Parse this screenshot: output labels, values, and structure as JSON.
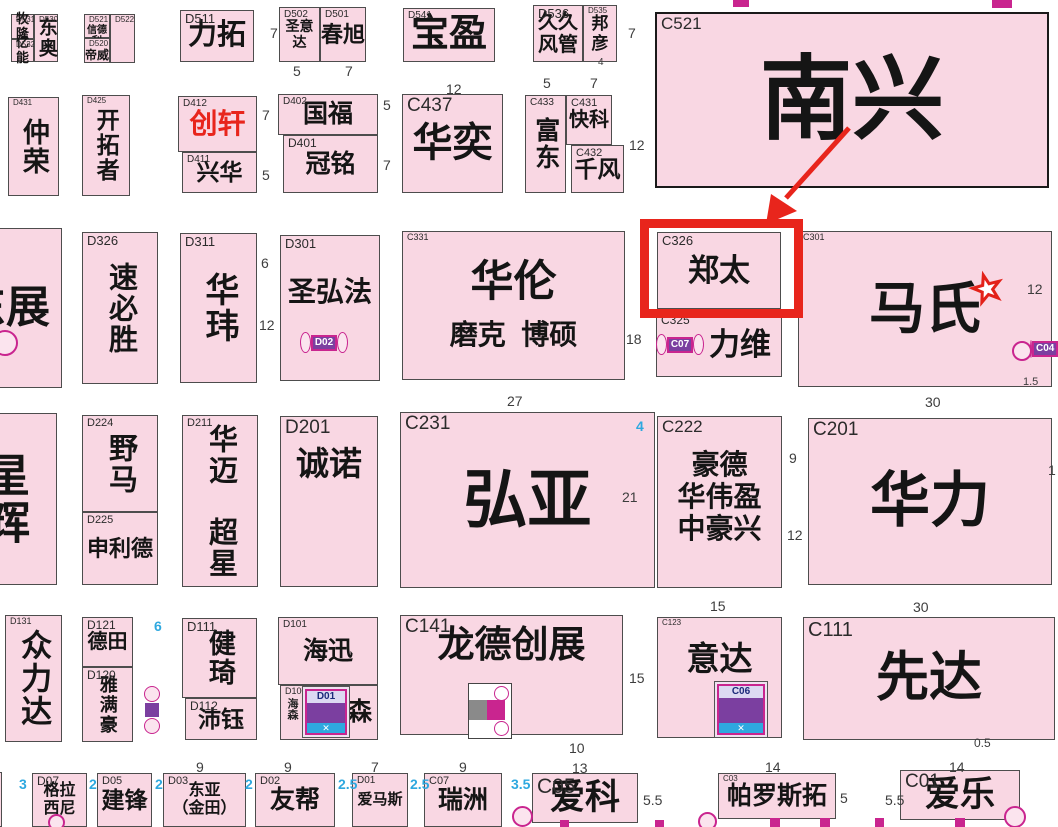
{
  "title": "exhibition-hall-floorplan",
  "colors": {
    "booth_fill": "#F9D7E3",
    "booth_border": "#4d4d4d",
    "big_border": "#1a1a1a",
    "text": "#151515",
    "dim_gray": "#3d3d3d",
    "dim_blue": "#2EA8DF",
    "highlight_red": "#E8251C",
    "special_red": "#E8251C",
    "icon_magenta": "#C9258F",
    "icon_purple": "#7B3FA0",
    "icon_cyan": "#2EA8DF",
    "icon_gray": "#8a8a8a",
    "star_red": "#E32119"
  },
  "highlight": {
    "target_code": "C326",
    "box": {
      "x": 640,
      "y": 219,
      "w": 163,
      "h": 99,
      "bw": 9
    },
    "arrow": {
      "x1": 849,
      "y1": 128,
      "x2": 786,
      "y2": 198,
      "head": "766,224 797,211 771,194"
    }
  },
  "star": {
    "cx": 987,
    "cy": 289,
    "R": 19,
    "r": 7.5,
    "inR": 9.5,
    "inr": 3.8
  },
  "booths": [
    {
      "c": "D531",
      "n": "牧隆",
      "x": 11,
      "y": 14,
      "w": 23,
      "h": 25,
      "s": 13,
      "cs": 8
    },
    {
      "c": "D532",
      "n": "亿能",
      "x": 11,
      "y": 39,
      "w": 23,
      "h": 23,
      "s": 13,
      "cs": 8
    },
    {
      "c": "D530",
      "n": "东奥",
      "x": 34,
      "y": 14,
      "w": 24,
      "h": 48,
      "v": 1,
      "s": 19,
      "cs": 8
    },
    {
      "c": "D521",
      "n": "信德利",
      "x": 84,
      "y": 14,
      "w": 26,
      "h": 24,
      "s": 10,
      "cs": 8,
      "va": "top",
      "tp": 10
    },
    {
      "c": "D520",
      "n": "帝威",
      "x": 84,
      "y": 38,
      "w": 26,
      "h": 25,
      "s": 12,
      "cs": 8,
      "va": "top",
      "tp": 10
    },
    {
      "c": "D522",
      "n": "",
      "x": 110,
      "y": 14,
      "w": 25,
      "h": 49,
      "cs": 8
    },
    {
      "c": "D511",
      "n": "力拓",
      "x": 180,
      "y": 10,
      "w": 74,
      "h": 52,
      "s": 29,
      "cs": 13
    },
    {
      "c": "D502",
      "n": "圣意达",
      "x": 279,
      "y": 7,
      "w": 41,
      "h": 55,
      "s": 14,
      "cs": 10
    },
    {
      "c": "D501",
      "n": "春旭",
      "x": 320,
      "y": 7,
      "w": 46,
      "h": 55,
      "s": 22,
      "cs": 10
    },
    {
      "c": "D541",
      "n": "宝盈",
      "x": 403,
      "y": 8,
      "w": 92,
      "h": 54,
      "s": 38,
      "cs": 10
    },
    {
      "c": "D536",
      "n": "久久\n风管",
      "x": 533,
      "y": 5,
      "w": 50,
      "h": 57,
      "s": 20,
      "cs": 13
    },
    {
      "c": "D535",
      "n": "邦\n彦",
      "x": 583,
      "y": 5,
      "w": 34,
      "h": 57,
      "s": 17,
      "cs": 8
    },
    {
      "c": "C521",
      "n": "南兴",
      "x": 655,
      "y": 12,
      "w": 394,
      "h": 176,
      "s": 92,
      "cs": 17,
      "bw": 2.5
    },
    {
      "c": "D431",
      "n": "仲荣",
      "x": 8,
      "y": 97,
      "w": 51,
      "h": 99,
      "v": 1,
      "s": 27,
      "cs": 8
    },
    {
      "c": "D425",
      "n": "开拓者",
      "x": 82,
      "y": 95,
      "w": 48,
      "h": 101,
      "v": 1,
      "s": 23,
      "cs": 8
    },
    {
      "c": "D412",
      "n": "创轩",
      "x": 178,
      "y": 96,
      "w": 79,
      "h": 56,
      "s": 28,
      "cs": 10,
      "col": "red"
    },
    {
      "c": "D411",
      "n": "兴华",
      "x": 182,
      "y": 152,
      "w": 75,
      "h": 41,
      "s": 23,
      "cs": 10
    },
    {
      "c": "D402",
      "n": "国福",
      "x": 278,
      "y": 94,
      "w": 100,
      "h": 41,
      "s": 25,
      "cs": 10
    },
    {
      "c": "D401",
      "n": "冠铭",
      "x": 283,
      "y": 135,
      "w": 95,
      "h": 58,
      "s": 25,
      "cs": 12
    },
    {
      "c": "C437",
      "n": "华奕",
      "x": 402,
      "y": 94,
      "w": 101,
      "h": 99,
      "s": 40,
      "cs": 19
    },
    {
      "c": "C433",
      "n": "富东",
      "x": 525,
      "y": 95,
      "w": 41,
      "h": 98,
      "v": 1,
      "s": 25,
      "cs": 10
    },
    {
      "c": "C431",
      "n": "快科",
      "x": 566,
      "y": 95,
      "w": 46,
      "h": 50,
      "s": 20,
      "cs": 11
    },
    {
      "c": "C432",
      "n": "千风",
      "x": 571,
      "y": 145,
      "w": 53,
      "h": 48,
      "s": 23,
      "cs": 11
    },
    {
      "c": "",
      "n": "东展",
      "x": -50,
      "y": 228,
      "w": 112,
      "h": 160,
      "s": 44
    },
    {
      "c": "D326",
      "n": "速必胜",
      "x": 82,
      "y": 232,
      "w": 76,
      "h": 152,
      "v": 1,
      "s": 29,
      "cs": 13
    },
    {
      "c": "D311",
      "n": "华玮",
      "x": 180,
      "y": 233,
      "w": 77,
      "h": 150,
      "v": 1,
      "s": 34,
      "cs": 13
    },
    {
      "c": "D301",
      "n": "圣弘法",
      "x": 280,
      "y": 235,
      "w": 100,
      "h": 146,
      "s": 28,
      "cs": 13,
      "va": "top",
      "tp": 40
    },
    {
      "c": "C331",
      "n": "华伦",
      "sub": "磨克  博硕",
      "x": 402,
      "y": 231,
      "w": 223,
      "h": 149,
      "s": 43,
      "ss": 28,
      "cs": 9
    },
    {
      "c": "C326",
      "n": "郑太",
      "x": 657,
      "y": 232,
      "w": 124,
      "h": 77,
      "s": 31,
      "cs": 13
    },
    {
      "c": "C325",
      "n": "力维",
      "x": 656,
      "y": 312,
      "w": 126,
      "h": 65,
      "s": 31,
      "cs": 12,
      "al": "right",
      "rp": 10
    },
    {
      "c": "C301",
      "n": "马氏",
      "x": 798,
      "y": 231,
      "w": 254,
      "h": 156,
      "s": 56,
      "cs": 9
    },
    {
      "c": "",
      "n": "星辉",
      "x": -50,
      "y": 413,
      "w": 107,
      "h": 172,
      "v": 1,
      "s": 45
    },
    {
      "c": "D224",
      "n": "野马",
      "x": 82,
      "y": 415,
      "w": 76,
      "h": 97,
      "v": 1,
      "s": 29,
      "cs": 11
    },
    {
      "c": "D225",
      "n": "申利德",
      "x": 82,
      "y": 512,
      "w": 76,
      "h": 73,
      "s": 22,
      "cs": 11
    },
    {
      "c": "D211",
      "n": "华迈　超星",
      "x": 182,
      "y": 415,
      "w": 76,
      "h": 172,
      "v": 1,
      "s": 29,
      "cs": 11
    },
    {
      "c": "D201",
      "n": "诚诺",
      "x": 280,
      "y": 416,
      "w": 98,
      "h": 171,
      "s": 33,
      "cs": 19,
      "va": "top",
      "tp": 28
    },
    {
      "c": "C231",
      "n": "弘亚",
      "x": 400,
      "y": 412,
      "w": 255,
      "h": 176,
      "s": 64,
      "cs": 19
    },
    {
      "c": "C222",
      "n": "豪德\n华伟盈\n中豪兴",
      "x": 657,
      "y": 416,
      "w": 125,
      "h": 172,
      "s": 28,
      "cs": 17,
      "va": "top",
      "tp": 32
    },
    {
      "c": "C201",
      "n": "华力",
      "x": 808,
      "y": 418,
      "w": 244,
      "h": 167,
      "s": 60,
      "cs": 19
    },
    {
      "c": "D131",
      "n": "众力达",
      "x": 5,
      "y": 615,
      "w": 57,
      "h": 127,
      "v": 1,
      "s": 31,
      "cs": 9
    },
    {
      "c": "D121",
      "n": "德田",
      "x": 82,
      "y": 617,
      "w": 51,
      "h": 50,
      "s": 20,
      "cs": 12
    },
    {
      "c": "D120",
      "n": "雅满豪",
      "x": 82,
      "y": 667,
      "w": 51,
      "h": 75,
      "v": 1,
      "s": 18,
      "cs": 12
    },
    {
      "c": "D111",
      "n": "健琦",
      "x": 182,
      "y": 618,
      "w": 75,
      "h": 80,
      "v": 1,
      "s": 27,
      "cs": 13
    },
    {
      "c": "D112",
      "n": "沛钰",
      "x": 185,
      "y": 698,
      "w": 72,
      "h": 42,
      "s": 23,
      "cs": 12
    },
    {
      "c": "D101",
      "n": "海迅",
      "x": 278,
      "y": 617,
      "w": 100,
      "h": 68,
      "s": 25,
      "cs": 10
    },
    {
      "c": "D100",
      "n": "海森",
      "x": 280,
      "y": 685,
      "w": 98,
      "h": 55,
      "s": 25,
      "cs": 9,
      "al": "right",
      "rp": 5
    },
    {
      "c": "C141",
      "n": "龙德创展",
      "x": 400,
      "y": 615,
      "w": 223,
      "h": 120,
      "s": 37,
      "cs": 19,
      "va": "top",
      "tp": 8
    },
    {
      "c": "C123",
      "n": "意达",
      "x": 657,
      "y": 617,
      "w": 125,
      "h": 121,
      "s": 33,
      "cs": 8,
      "va": "top",
      "tp": 22
    },
    {
      "c": "C111",
      "n": "先达",
      "x": 803,
      "y": 617,
      "w": 252,
      "h": 123,
      "s": 53,
      "cs": 20
    },
    {
      "c": "",
      "n": "",
      "x": -16,
      "y": 772,
      "w": 18,
      "h": 55
    },
    {
      "c": "D07",
      "n": "格拉\n西尼",
      "x": 32,
      "y": 773,
      "w": 55,
      "h": 54,
      "s": 16,
      "cs": 12
    },
    {
      "c": "D05",
      "n": "建锋",
      "x": 97,
      "y": 773,
      "w": 55,
      "h": 54,
      "s": 23,
      "cs": 11
    },
    {
      "c": "D03",
      "n": "东亚\n（金田）",
      "x": 163,
      "y": 773,
      "w": 83,
      "h": 54,
      "s": 16,
      "cs": 11
    },
    {
      "c": "D02",
      "n": "友帮",
      "x": 255,
      "y": 773,
      "w": 80,
      "h": 54,
      "s": 25,
      "cs": 11
    },
    {
      "c": "D01",
      "n": "爱马斯",
      "x": 352,
      "y": 773,
      "w": 56,
      "h": 54,
      "s": 15,
      "cs": 10
    },
    {
      "c": "C07",
      "n": "瑞洲",
      "x": 424,
      "y": 773,
      "w": 78,
      "h": 54,
      "s": 25,
      "cs": 11
    },
    {
      "c": "C05",
      "n": "爱科",
      "x": 532,
      "y": 773,
      "w": 106,
      "h": 50,
      "s": 35,
      "cs": 21
    },
    {
      "c": "C03",
      "n": "帕罗斯拓",
      "x": 718,
      "y": 773,
      "w": 118,
      "h": 46,
      "s": 25,
      "cs": 8
    },
    {
      "c": "C01",
      "n": "爱乐",
      "x": 900,
      "y": 770,
      "w": 120,
      "h": 50,
      "s": 35,
      "cs": 19
    }
  ],
  "dims": [
    {
      "t": "7",
      "x": 270,
      "y": 26
    },
    {
      "t": "5",
      "x": 293,
      "y": 64
    },
    {
      "t": "7",
      "x": 345,
      "y": 64
    },
    {
      "t": "12",
      "x": 446,
      "y": 82
    },
    {
      "t": "5",
      "x": 543,
      "y": 76
    },
    {
      "t": "7",
      "x": 590,
      "y": 76
    },
    {
      "t": "4",
      "x": 598,
      "y": 58,
      "s": 10
    },
    {
      "t": "7",
      "x": 628,
      "y": 26
    },
    {
      "t": "7",
      "x": 262,
      "y": 108
    },
    {
      "t": "5",
      "x": 262,
      "y": 168
    },
    {
      "t": "5",
      "x": 383,
      "y": 98
    },
    {
      "t": "7",
      "x": 383,
      "y": 158
    },
    {
      "t": "12",
      "x": 629,
      "y": 138
    },
    {
      "t": "6",
      "x": 261,
      "y": 256
    },
    {
      "t": "12",
      "x": 259,
      "y": 318
    },
    {
      "t": "18",
      "x": 626,
      "y": 332
    },
    {
      "t": "12",
      "x": 1027,
      "y": 282
    },
    {
      "t": "1.5",
      "x": 1023,
      "y": 377,
      "s": 11
    },
    {
      "t": "27",
      "x": 507,
      "y": 394
    },
    {
      "t": "4",
      "x": 636,
      "y": 419,
      "c": "b"
    },
    {
      "t": "21",
      "x": 622,
      "y": 490
    },
    {
      "t": "9",
      "x": 789,
      "y": 451
    },
    {
      "t": "12",
      "x": 787,
      "y": 528
    },
    {
      "t": "15",
      "x": 710,
      "y": 599
    },
    {
      "t": "30",
      "x": 925,
      "y": 395
    },
    {
      "t": "1",
      "x": 1048,
      "y": 463
    },
    {
      "t": "6",
      "x": 154,
      "y": 619,
      "c": "b"
    },
    {
      "t": "15",
      "x": 629,
      "y": 671
    },
    {
      "t": "30",
      "x": 913,
      "y": 600
    },
    {
      "t": "0.5",
      "x": 974,
      "y": 737,
      "s": 12
    },
    {
      "t": "10",
      "x": 569,
      "y": 741
    },
    {
      "t": "13",
      "x": 572,
      "y": 761
    },
    {
      "t": "9",
      "x": 196,
      "y": 760
    },
    {
      "t": "9",
      "x": 284,
      "y": 760
    },
    {
      "t": "7",
      "x": 371,
      "y": 760
    },
    {
      "t": "9",
      "x": 459,
      "y": 760
    },
    {
      "t": "14",
      "x": 765,
      "y": 760
    },
    {
      "t": "14",
      "x": 949,
      "y": 760
    },
    {
      "t": "3",
      "x": 19,
      "y": 777,
      "c": "b"
    },
    {
      "t": "2",
      "x": 89,
      "y": 777,
      "c": "b"
    },
    {
      "t": "2",
      "x": 155,
      "y": 777,
      "c": "b"
    },
    {
      "t": "2",
      "x": 245,
      "y": 777,
      "c": "b"
    },
    {
      "t": "2.5",
      "x": 338,
      "y": 777,
      "c": "b"
    },
    {
      "t": "2.5",
      "x": 410,
      "y": 777,
      "c": "b"
    },
    {
      "t": "3.5",
      "x": 511,
      "y": 777,
      "c": "b"
    },
    {
      "t": "5.5",
      "x": 643,
      "y": 793
    },
    {
      "t": "5",
      "x": 840,
      "y": 791
    },
    {
      "t": "5.5",
      "x": 885,
      "y": 793
    }
  ],
  "icons": [
    {
      "type": "elev_small",
      "label": "D02",
      "x": 300,
      "y": 329,
      "w": 48,
      "h": 27
    },
    {
      "type": "elev_small",
      "label": "C07",
      "x": 656,
      "y": 331,
      "w": 48,
      "h": 27
    },
    {
      "type": "elev_small",
      "label": "C04",
      "x": 1030,
      "y": 337,
      "w": 28,
      "h": 24
    },
    {
      "type": "column",
      "x": 141,
      "y": 686,
      "w": 22,
      "h": 48
    },
    {
      "type": "elev_big",
      "label": "D01",
      "x": 302,
      "y": 686,
      "w": 48,
      "h": 52
    },
    {
      "type": "elev_big",
      "label": "C06",
      "x": 714,
      "y": 681,
      "w": 54,
      "h": 57
    },
    {
      "type": "machine",
      "x": 468,
      "y": 683,
      "w": 42,
      "h": 54
    },
    {
      "type": "vtext",
      "label": "海森",
      "x": 284,
      "y": 698,
      "w": 14,
      "h": 40
    },
    {
      "type": "circle",
      "x": -8,
      "y": 330,
      "d": 22
    },
    {
      "type": "circle",
      "x": 1012,
      "y": 341,
      "d": 16
    },
    {
      "type": "circle",
      "x": 512,
      "y": 806,
      "d": 17
    },
    {
      "type": "circle",
      "x": 698,
      "y": 812,
      "d": 15
    },
    {
      "type": "circle",
      "x": 1004,
      "y": 806,
      "d": 18
    },
    {
      "type": "circle",
      "x": 48,
      "y": 814,
      "d": 13
    },
    {
      "type": "square",
      "x": 770,
      "y": 818,
      "d": 10
    },
    {
      "type": "square",
      "x": 820,
      "y": 818,
      "d": 10
    },
    {
      "type": "square",
      "x": 955,
      "y": 818,
      "d": 10
    },
    {
      "type": "square",
      "x": 655,
      "y": 820,
      "d": 9
    },
    {
      "type": "square",
      "x": 560,
      "y": 820,
      "d": 9
    },
    {
      "type": "square",
      "x": 875,
      "y": 818,
      "d": 9
    },
    {
      "type": "topbar",
      "x": 733,
      "y": 0,
      "w": 16,
      "h": 7
    },
    {
      "type": "topbar",
      "x": 992,
      "y": 0,
      "w": 20,
      "h": 8
    }
  ]
}
